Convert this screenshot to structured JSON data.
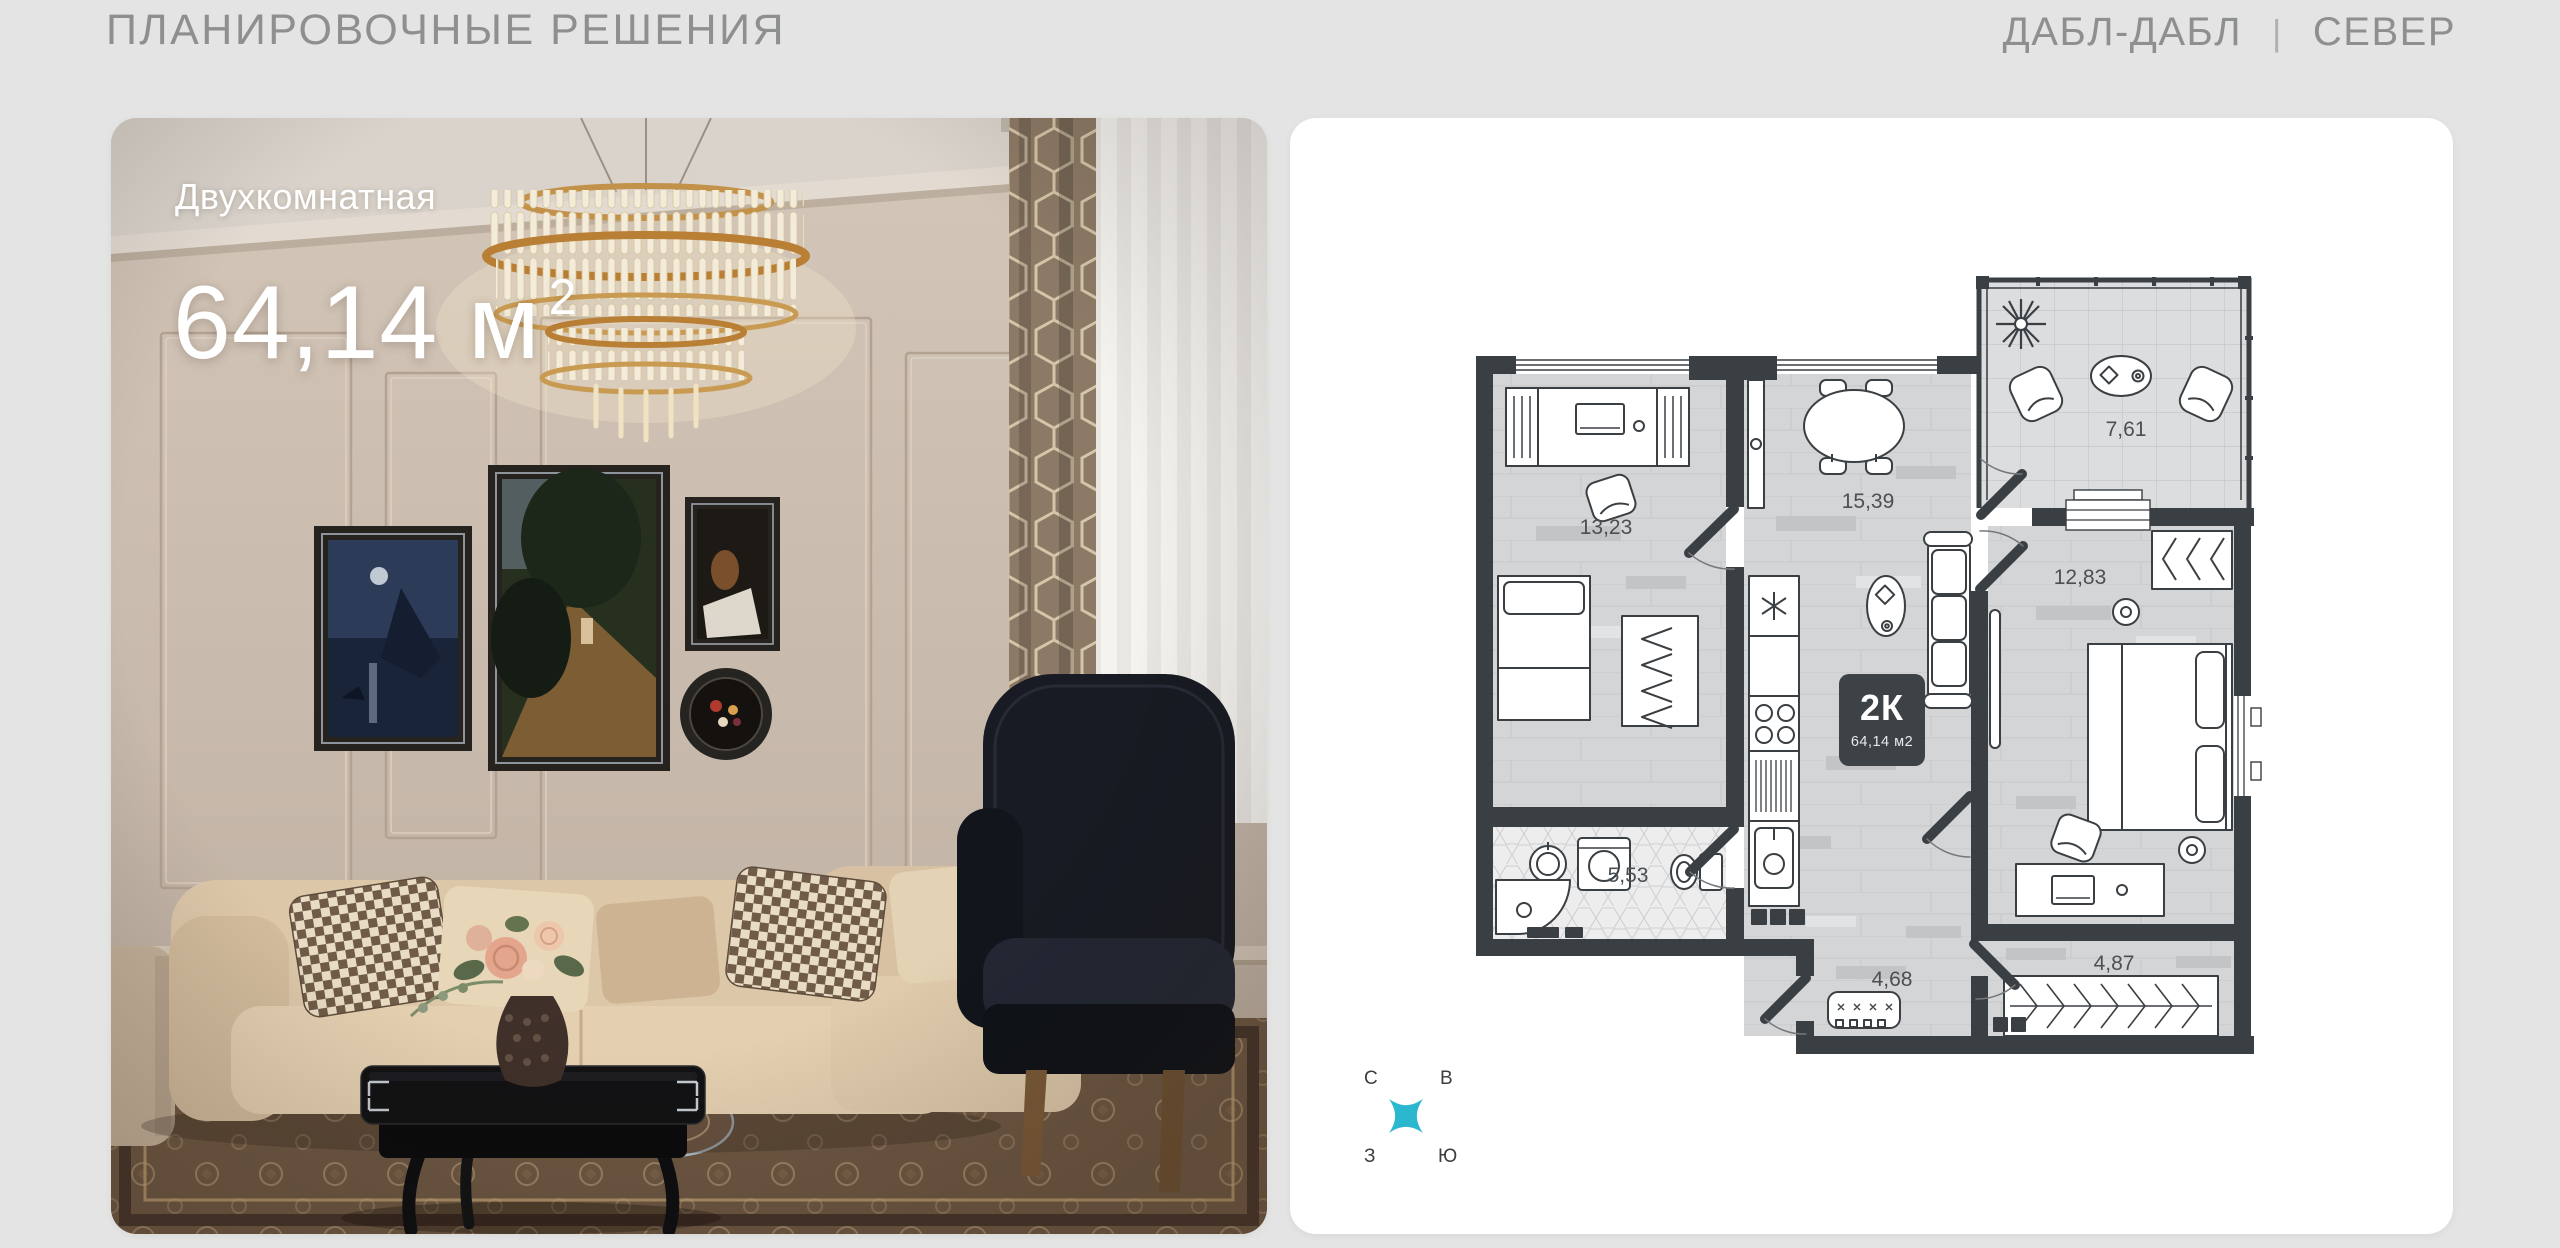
{
  "header": {
    "title": "ПЛАНИРОВОЧНЫЕ РЕШЕНИЯ",
    "project_name": "ДАБЛ-ДАБЛ",
    "divider": "|",
    "section_name": "СЕВЕР"
  },
  "apartment_card": {
    "type_label": "Двухкомнатная",
    "area_value": "64,14",
    "area_unit": "м",
    "area_superscript": "2"
  },
  "floor_plan": {
    "badge": {
      "type_short": "2К",
      "area_text": "64,14 м2"
    },
    "rooms": [
      {
        "id": "bedroom-office",
        "area": "13,23"
      },
      {
        "id": "kitchen-living",
        "area": "15,39"
      },
      {
        "id": "loggia",
        "area": "7,61"
      },
      {
        "id": "bedroom",
        "area": "12,83"
      },
      {
        "id": "bathroom",
        "area": "5,53"
      },
      {
        "id": "hallway",
        "area": "4,68"
      },
      {
        "id": "corridor",
        "area": "4,87"
      }
    ],
    "compass": {
      "north_label": "С",
      "east_label": "В",
      "west_label": "З",
      "south_label": "Ю"
    }
  },
  "colors": {
    "page_background": "#e3e4e3",
    "header_text": "#8e8f90",
    "card_background": "#ffffff",
    "plan_wall": "#3a3f43",
    "plan_floor": "#d4d5d6",
    "plan_label": "#4b5054",
    "badge_background": "#3d4246",
    "badge_text": "#ffffff",
    "compass_star": "#2bb8ce",
    "overlay_text": "#ffffff"
  }
}
